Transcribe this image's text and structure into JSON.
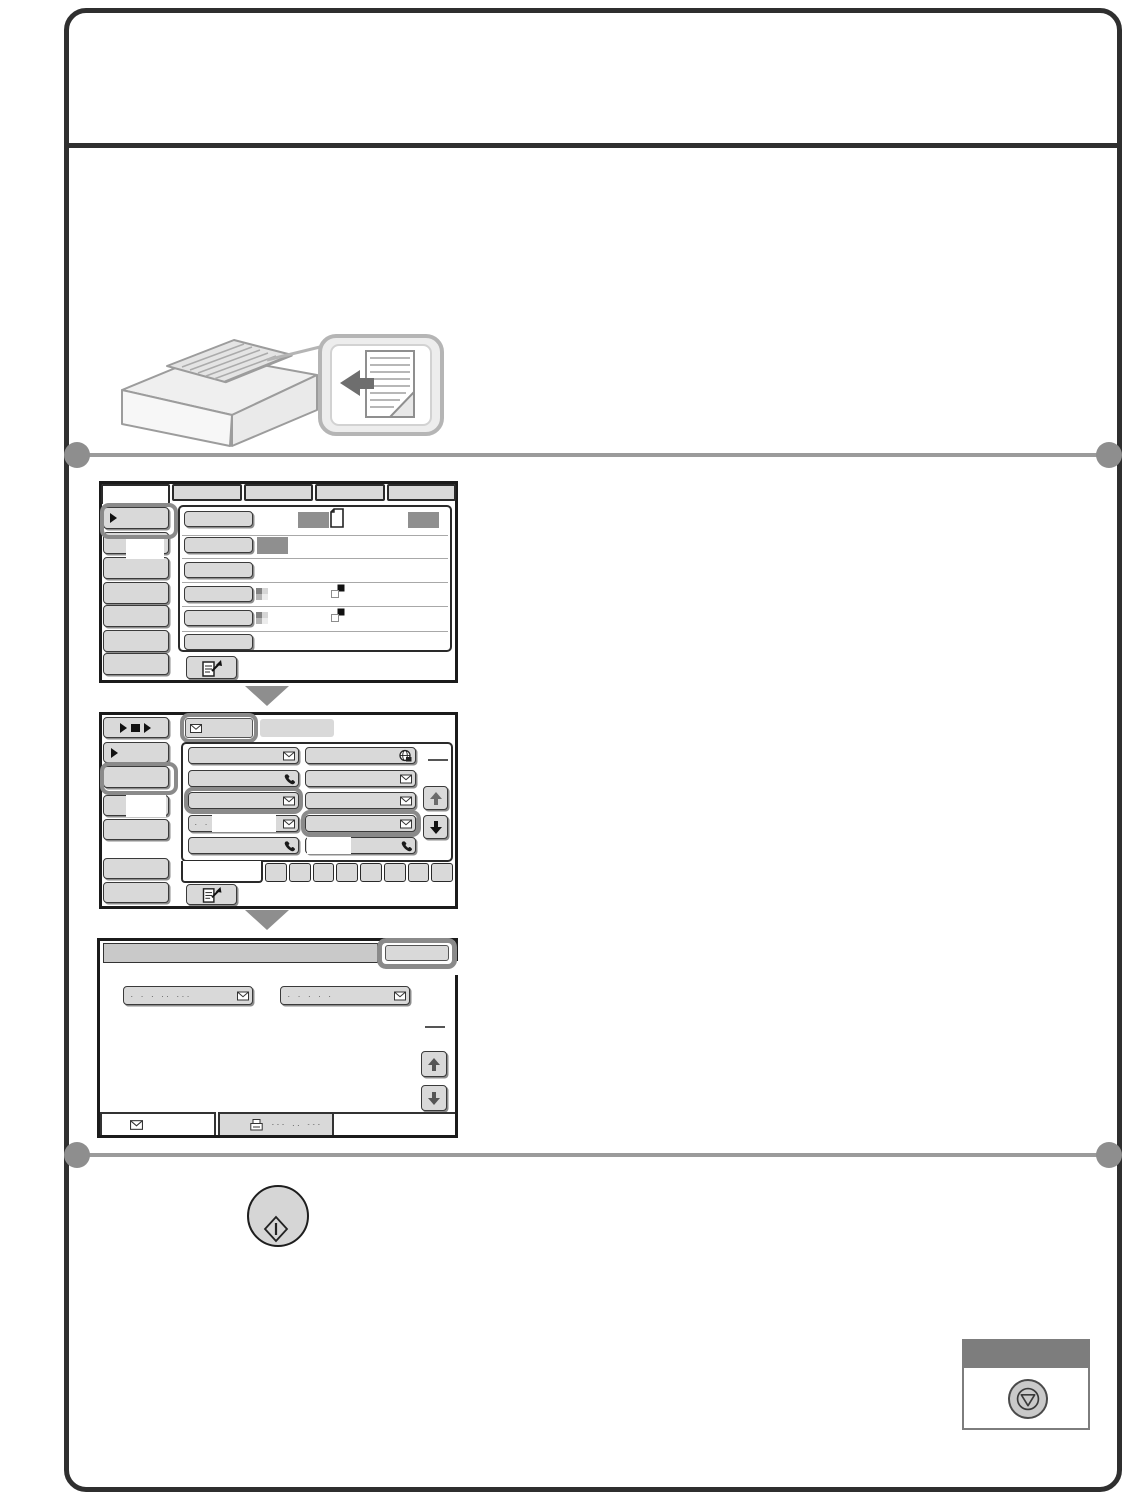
{
  "page": {
    "border_color": "#2f2f2f",
    "section_divider_color": "#9b9b9b",
    "section_divider_dot_color": "#8e8e8e"
  },
  "colors": {
    "button_fill": "#d9d9d9",
    "button_border": "#3a3a3a",
    "highlight_ring": "#8a8a8a",
    "value_swatch": "#8f8f8f",
    "screen_border": "#1b1b1b",
    "flow_arrow": "#8e8e8e",
    "stop_panel_header": "#7d7d7d",
    "title_bar_fill": "#c9c9c9"
  },
  "screen1": {
    "tab_count": 5,
    "selected_tab_index": 0,
    "sidebar_button_count": 7,
    "option_row_count": 6
  },
  "screen2": {
    "sidebar_button_count": 7,
    "address_button_rows": 5,
    "address_button_columns": 2,
    "index_tab_count": 9,
    "row4_left_dots": ". .  . ..  ...."
  },
  "screen3": {
    "chip1_dots": ". . . ..  ...",
    "chip2_dots": ". . . . .",
    "tab2_dots": "--- .. ---"
  },
  "icons": {
    "screen1": [
      "play-icon",
      "document-icon",
      "checkerboard-icon",
      "two-sided-icon",
      "preview-icon"
    ],
    "screen2": [
      "play-square-play-icon",
      "play-icon",
      "envelope-icon",
      "phone-icon",
      "internet-fax-icon",
      "up-arrow-icon",
      "down-arrow-icon",
      "preview-icon"
    ],
    "screen3": [
      "envelope-icon",
      "fax-machine-icon",
      "up-arrow-icon",
      "down-arrow-icon"
    ],
    "keys": [
      "start-key-icon",
      "stop-key-icon"
    ]
  }
}
